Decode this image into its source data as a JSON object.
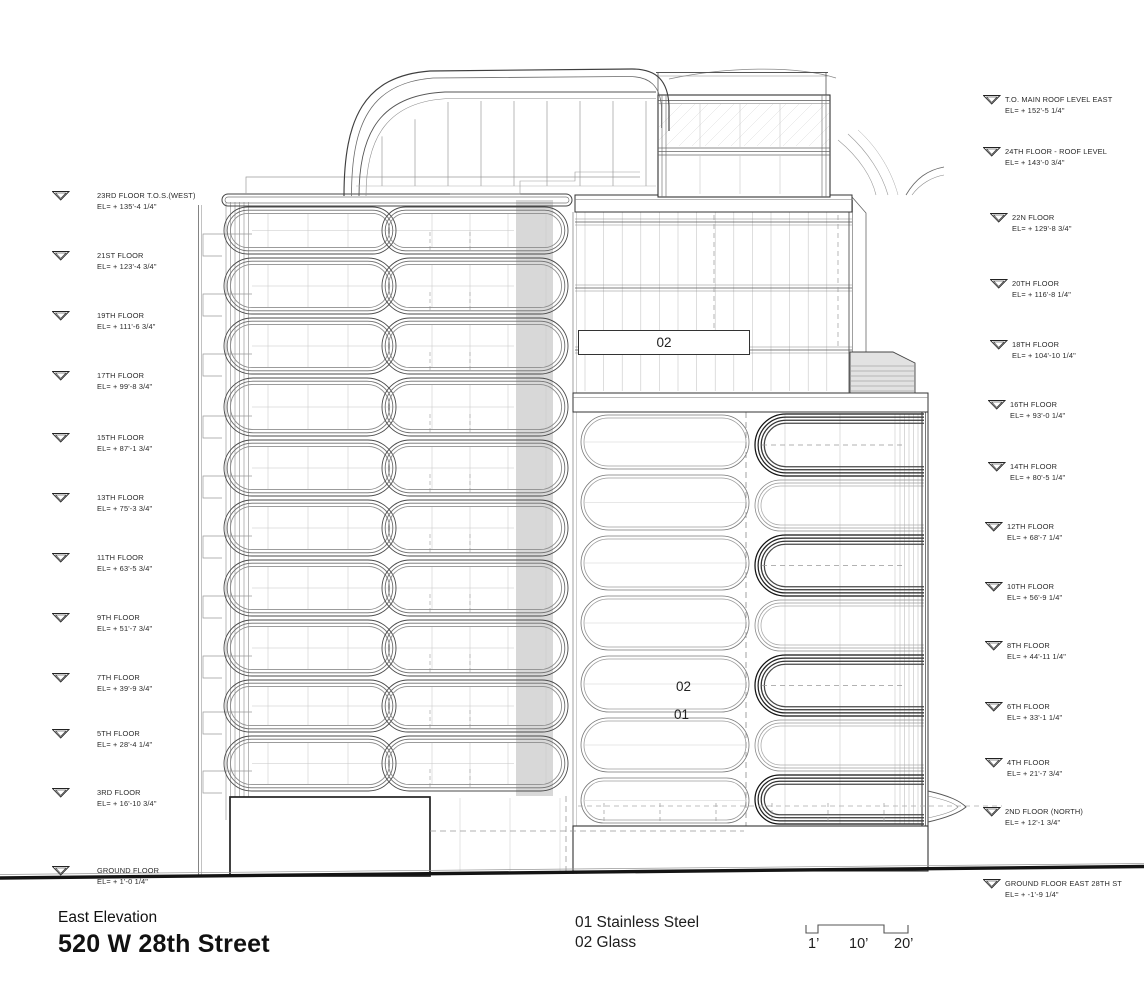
{
  "title": {
    "view_name": "East Elevation",
    "project_name": "520 W 28th Street"
  },
  "legend": {
    "line1": "01 Stainless Steel",
    "line2": "02 Glass"
  },
  "scale_bar": {
    "labels": [
      "1’",
      "10’",
      "20’"
    ]
  },
  "material_tags": {
    "upper_glass": "02",
    "mid_glass": "02",
    "steel": "01"
  },
  "left_levels": [
    {
      "name": "23RD FLOOR T.O.S.(WEST)",
      "elevation": "EL= + 135'-4 1/4\""
    },
    {
      "name": "21ST FLOOR",
      "elevation": "EL= + 123'-4 3/4\""
    },
    {
      "name": "19TH FLOOR",
      "elevation": "EL= + 111'-6 3/4\""
    },
    {
      "name": "17TH FLOOR",
      "elevation": "EL= + 99'-8 3/4\""
    },
    {
      "name": "15TH FLOOR",
      "elevation": "EL= + 87'-1 3/4\""
    },
    {
      "name": "13TH FLOOR",
      "elevation": "EL= + 75'-3 3/4\""
    },
    {
      "name": "11TH FLOOR",
      "elevation": "EL= + 63'-5 3/4\""
    },
    {
      "name": "9TH FLOOR",
      "elevation": "EL= + 51'-7 3/4\""
    },
    {
      "name": "7TH FLOOR",
      "elevation": "EL= + 39'-9 3/4\""
    },
    {
      "name": "5TH FLOOR",
      "elevation": "EL= + 28'-4 1/4\""
    },
    {
      "name": "3RD FLOOR",
      "elevation": "EL= + 16'-10 3/4\""
    },
    {
      "name": "GROUND FLOOR",
      "elevation": "EL= + 1'-0 1/4\""
    }
  ],
  "right_levels": [
    {
      "name": "T.O. MAIN ROOF LEVEL EAST",
      "elevation": "EL= + 152'-5 1/4\""
    },
    {
      "name": "24TH FLOOR - ROOF LEVEL",
      "elevation": "EL= + 143'-0 3/4\""
    },
    {
      "name": "22N FLOOR",
      "elevation": "EL= + 129'-8 3/4\""
    },
    {
      "name": "20TH FLOOR",
      "elevation": "EL= + 116'-8 1/4\""
    },
    {
      "name": "18TH FLOOR",
      "elevation": "EL= + 104'-10 1/4\""
    },
    {
      "name": "16TH FLOOR",
      "elevation": "EL= + 93'-0 1/4\""
    },
    {
      "name": "14TH FLOOR",
      "elevation": "EL= + 80'-5 1/4\""
    },
    {
      "name": "12TH FLOOR",
      "elevation": "EL= + 68'-7 1/4\""
    },
    {
      "name": "10TH FLOOR",
      "elevation": "EL= + 56'-9 1/4\""
    },
    {
      "name": "8TH FLOOR",
      "elevation": "EL= + 44'-11 1/4\""
    },
    {
      "name": "6TH FLOOR",
      "elevation": "EL= + 33'-1 1/4\""
    },
    {
      "name": "4TH FLOOR",
      "elevation": "EL= + 21'-7 3/4\""
    },
    {
      "name": "2ND FLOOR (NORTH)",
      "elevation": "EL= + 12'-1 3/4\""
    },
    {
      "name": "GROUND FLOOR EAST 28TH ST",
      "elevation": "EL= + -1'-9 1/4\""
    }
  ],
  "colors": {
    "ink": "#1f1f1f",
    "line_dark": "#333333",
    "line_light": "#aaaaaa",
    "shade_gray": "#d6d6d6"
  }
}
